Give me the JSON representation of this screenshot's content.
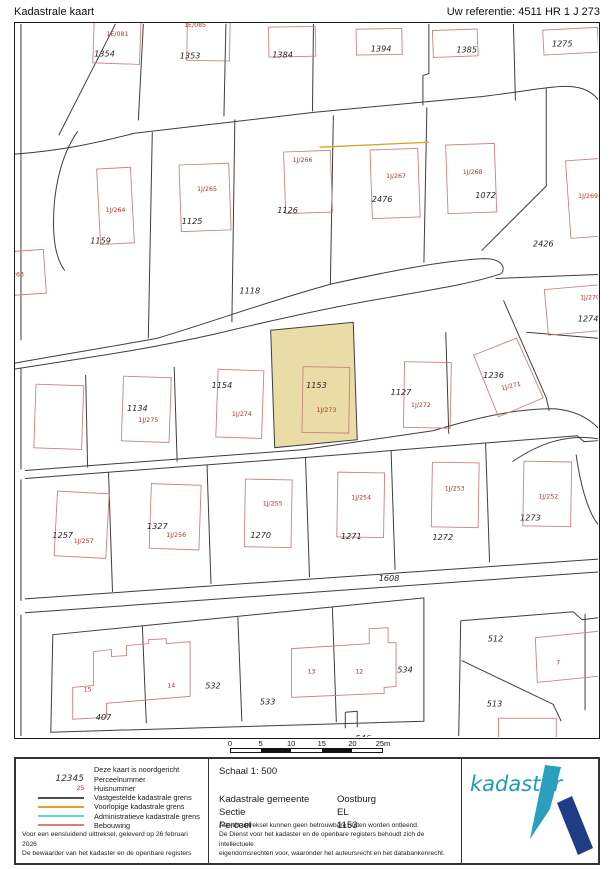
{
  "header": {
    "title": "Kadastrale kaart",
    "reference": "Uw referentie: 4511 HR 1 J 273"
  },
  "map": {
    "highlighted_parcel": "1153",
    "highlight_color": "#e9dca6",
    "boundary_color": "#3d3d3d",
    "building_color": "#c9837e",
    "building_text_color": "#b1312a",
    "provisional_boundary_color": "#d4a31f",
    "parcels": [
      "1354",
      "1353",
      "1384",
      "1394",
      "1385",
      "1275",
      "1159",
      "1125",
      "1126",
      "2476",
      "1072",
      "2426",
      "1118",
      "1274",
      "1134",
      "1154",
      "1153",
      "1127",
      "1236",
      "1257",
      "1327",
      "1270",
      "1271",
      "1272",
      "1273",
      "1608",
      "407",
      "532",
      "533",
      "534",
      "546",
      "512",
      "513"
    ],
    "buildings": [
      "1E/081",
      "1E/085",
      "1J/263",
      "1J/264",
      "1J/265",
      "1J/266",
      "1J/267",
      "1J/268",
      "1J/269",
      "1J/270",
      "1J/271",
      "1J/272",
      "1J/273",
      "1J/274",
      "1J/275",
      "1J/257",
      "1J/256",
      "1J/255",
      "1J/254",
      "1J/253",
      "1J/252"
    ],
    "house_numbers": [
      "15",
      "14",
      "13",
      "12",
      "7"
    ]
  },
  "scalebar": {
    "labels": [
      "0",
      "5",
      "10",
      "15",
      "20",
      "25m"
    ]
  },
  "legend": {
    "north_note": "Deze kaart is noordgericht",
    "perceel_symbol": "12345",
    "perceel_label": "Perceelnummer",
    "huis_symbol": "25",
    "huis_label": "Huisnummer",
    "line_items": [
      {
        "label": "Vastgestelde kadastrale grens",
        "color": "#4d4d4d"
      },
      {
        "label": "Voorlopige kadastrale grens",
        "color": "#dca62b"
      },
      {
        "label": "Administratieve kadastrale grens",
        "color": "#5fd8d2"
      },
      {
        "label": "Bebouwing",
        "color": "#d97f78"
      }
    ],
    "footer_line1": "Voor een eensluidend uittreksel, geleverd op 26 februari 2026",
    "footer_line2": "De bewaarder van het kadaster en de openbare registers"
  },
  "info": {
    "scale": "Schaal 1: 500",
    "fields": [
      {
        "label": "Kadastrale gemeente",
        "value": "Oostburg"
      },
      {
        "label": "Sectie",
        "value": "EL"
      },
      {
        "label": "Perceel",
        "value": "1153"
      }
    ],
    "disclaimer": "Aan dit uittreksel kunnen geen betrouwbare maten worden ontleend.\nDe Dienst voor het kadaster en de openbare registers behoudt zich de intellectuele\neigendomsrechten voor, waaronder het auteursrecht en het databankenrecht."
  },
  "logo": {
    "text": "kadaster",
    "text_color": "#1d9db6",
    "blade_color": "#2d9fbe",
    "bar_color": "#1f3c87"
  }
}
